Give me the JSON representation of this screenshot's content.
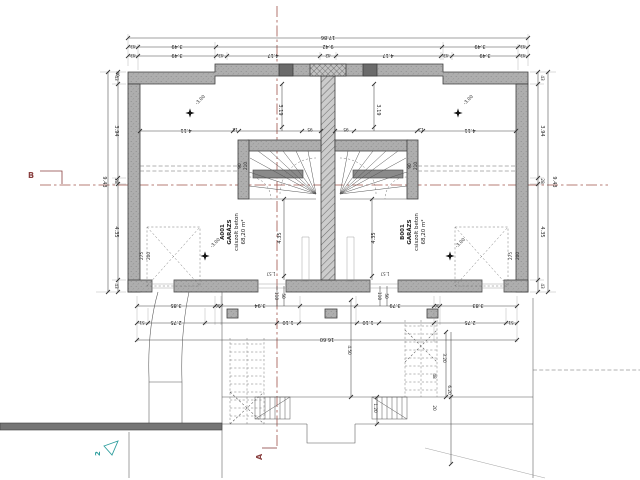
{
  "drawing_title": "garage floor plan",
  "rooms": {
    "left": {
      "id": "A001",
      "name": "GARÁZS",
      "finish": "csiszolt beton",
      "area": "68,20 m²"
    },
    "right": {
      "id": "B001",
      "name": "GARÁZS",
      "finish": "csiszolt beton",
      "area": "68,20 m²"
    }
  },
  "levels": {
    "floor": "-3.00"
  },
  "door": {
    "w": "90",
    "h": "210"
  },
  "parking": {
    "w": "275",
    "d": "200"
  },
  "markers": {
    "section_a": "A",
    "section_b": "B",
    "node": "2"
  },
  "dims": {
    "top": {
      "total": "17.86",
      "corner": "40",
      "row2": [
        "43",
        "3.49",
        "9.42",
        "3.49",
        "43"
      ],
      "row3": [
        "43",
        "3.49",
        "43",
        "4.17",
        "42",
        "4.17",
        "43",
        "3.49",
        "43"
      ]
    },
    "side": {
      "total": "9.43",
      "segs": [
        "43",
        "3.94",
        "28",
        "4.35",
        "43"
      ]
    },
    "inner": {
      "span": "4.11",
      "tick": "12",
      "stair": "95",
      "axis": "3.19",
      "depth": "4.35",
      "sill": "1.57"
    },
    "bottom": {
      "rowA": [
        "3.85",
        "30",
        "3.94",
        "3.79",
        "30",
        "3.83"
      ],
      "rowB": [
        "51",
        "2.75",
        "1.10",
        "1.10",
        "2.75",
        "51"
      ],
      "total": "16.60",
      "v_a": "110",
      "v_b": "50",
      "pit_w": "4.50",
      "pit_d": "1.20",
      "ramp_a": "3.20",
      "ramp_b": "6.20",
      "r48": "48",
      "r20": "20"
    }
  }
}
